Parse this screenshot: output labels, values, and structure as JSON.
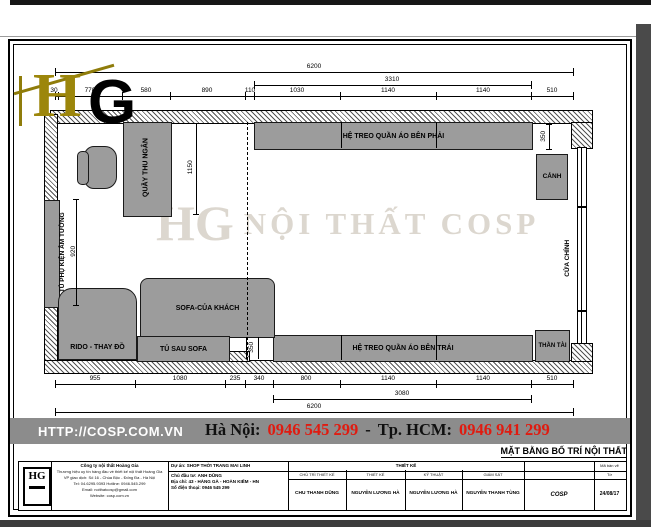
{
  "watermark": {
    "mark": "HG",
    "text": "NỘI THẤT COSP"
  },
  "logo": {
    "h": "H",
    "g": "G"
  },
  "plan": {
    "labels": {
      "cashier": "QUẦY THU NGÂN",
      "wall_cabinet": "TỦ PHỤ KIỆN ÂM TƯỜNG",
      "hang_right": "HỆ TREO QUẦN ÁO BÊN PHẢI",
      "hang_left": "HỆ TREO QUẦN ÁO BÊN TRÁI",
      "plant": "CẢNH",
      "door": "CỬA CHÍNH",
      "altar": "THẦN TÀI",
      "sofa": "SOFA-CỦA KHÁCH",
      "sofa_cabinet": "TỦ SAU SOFA",
      "changing": "RIDO - THAY ĐỒ"
    },
    "dims": {
      "top_total": "6200",
      "top_sub": "3310",
      "top_segs": [
        "30",
        "770",
        "580",
        "890",
        "110",
        "1030",
        "1140",
        "1140",
        "510"
      ],
      "bot_segs": [
        "955",
        "1080",
        "235",
        "340",
        "800",
        "1140",
        "1140",
        "510"
      ],
      "bot_sub": "3080",
      "bot_total": "6200",
      "v_counter": "1150",
      "v_cabinet": "920",
      "v_right_gap": "350",
      "v_sofa_gap": "350"
    }
  },
  "footer": {
    "url": "HTTP://COSP.COM.VN",
    "hanoi_label": "Hà Nội:",
    "hanoi_phone": "0946 545 299",
    "separator": "-",
    "hcm_label": "Tp. HCM:",
    "hcm_phone": "0946 941 299",
    "drawing_title": "MẶT BẰNG BỐ TRÍ NỘI THẤT",
    "accent_red": "#e01b10",
    "bar_gray": "#8c8c8c"
  },
  "titleblock": {
    "logo_text": "HG",
    "company": {
      "l1": "Công ty nội thất Hoàng Gia",
      "l2": "Thương hiệu uy tín hàng đầu về thiết kế nội thất Hoàng Gia",
      "l3": "VP giao dịch: Số 16 - Chùa Bộc - Đống Đa - Hà Nội",
      "l4": "Tel: 04.6295.9393   Hotline: 0946.545.299",
      "l5": "Email: noithatcosp@gmail.com",
      "l6": "Website: cosp.com.vn"
    },
    "project": {
      "l1": "Dự án: SHOP THỜI TRANG MAI LINH",
      "l2": "Chủ đầu tư: ANH DŨNG",
      "l3": "Địa chỉ: 43 - HÀNG GÀ - HOÀN KIẾM - HN",
      "l4": "Số điện thoại: 0946 545 299"
    },
    "section_header": "THIẾT KẾ",
    "cols": [
      {
        "role": "CHỦ TRÌ THIẾT KẾ",
        "name": "CHU THANH DŨNG"
      },
      {
        "role": "THIẾT KẾ",
        "name": "NGUYỄN LƯƠNG HÀ"
      },
      {
        "role": "KỸ THUẬT",
        "name": "NGUYỄN LƯƠNG HÀ"
      },
      {
        "role": "GIÁM SÁT",
        "name": "NGUYỄN THANH TÙNG"
      }
    ],
    "stamp": "COSP",
    "right_top": "Mã bản vẽ",
    "right_mid": "Tờ",
    "date": "24/08/17"
  }
}
